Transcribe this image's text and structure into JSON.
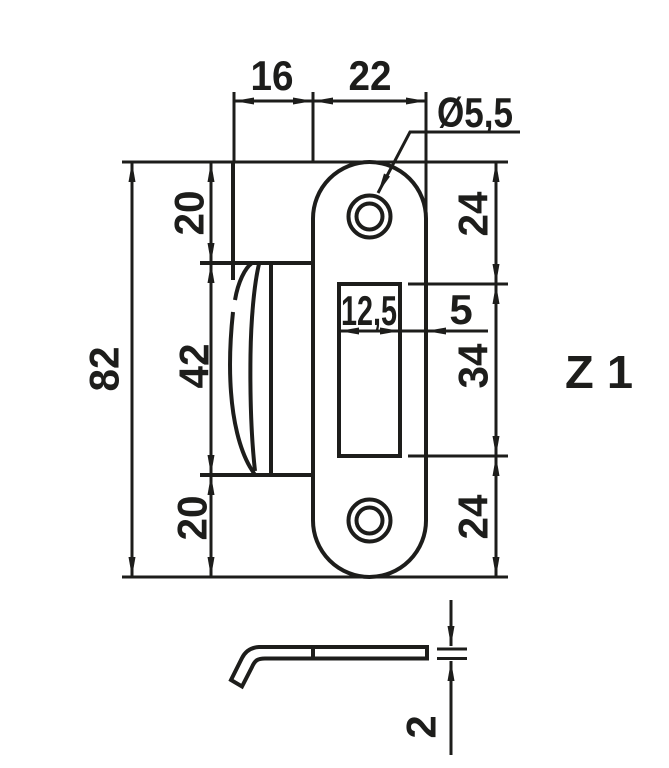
{
  "page": {
    "background": "#ffffff",
    "line_color": "#1d1d1b"
  },
  "drawing_label": "Z 1",
  "front_view": {
    "top_dims": {
      "flange_width": "16",
      "plate_width": "22"
    },
    "hole_callout": {
      "diameter": "Ø5,5"
    },
    "left_dims": {
      "top": "20",
      "middle": "42",
      "bottom": "20",
      "overall": "82"
    },
    "right_dims": {
      "top": "24",
      "slot_to_edge": "5",
      "middle": "34",
      "bottom": "24"
    },
    "slot_dims": {
      "width": "12,5"
    }
  },
  "side_view": {
    "thickness": "2"
  }
}
